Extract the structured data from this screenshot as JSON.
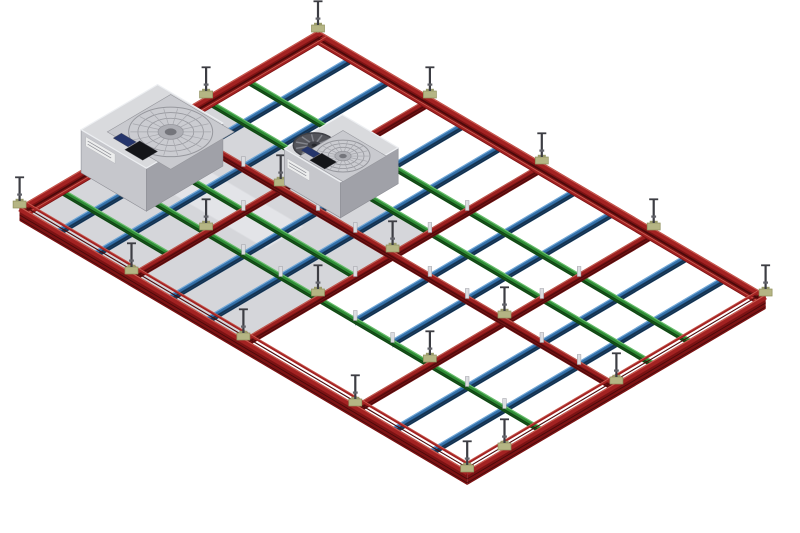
{
  "viewport": {
    "width": 800,
    "height": 533,
    "background": "#ffffff"
  },
  "scene": {
    "projection": {
      "origin_x": 318,
      "origin_y": 33,
      "cell_x": 37.3,
      "cell_y": 22
    },
    "grid": {
      "cells_u": 12,
      "cells_v": 8
    },
    "beam_styles": {
      "perimeter": {
        "side": "#7c1314",
        "ridge": "#4a0a0b",
        "top": "#a32222",
        "hi": "#c85a50",
        "side_h": 12,
        "top_w": 5
      },
      "red_runner": {
        "side": "#701112",
        "ridge": "#4c0a0b",
        "top": "#9c2020",
        "hi": "#c05a50",
        "side_h": 8,
        "top_w": 4
      },
      "blue": {
        "side": "#1c4165",
        "ridge": "#132e49",
        "top": "#336fa8",
        "hi": "#74aad9",
        "side_h": 6.5,
        "top_w": 3.2
      },
      "green": {
        "side": "#1a5c1e",
        "ridge": "#114214",
        "top": "#2f8c36",
        "hi": "#6cc06f",
        "side_h": 5.5,
        "top_w": 3.2
      }
    },
    "panels": [
      {
        "name": "blank-panel-area",
        "u0": 0,
        "u1": 6,
        "v0": 3,
        "v1": 8,
        "fill": "#d5d6da",
        "edge": "#c3c4c9"
      },
      {
        "name": "panel-highlight-strip",
        "u0": 1.6,
        "u1": 4.2,
        "v0": 4.6,
        "v1": 5.6,
        "fill": "#e3e4e8",
        "edge": "#dcdde1"
      }
    ],
    "beams": {
      "perimeter": [
        {
          "from": [
            0,
            0
          ],
          "to": [
            12,
            0
          ],
          "in": [
            0,
            1
          ]
        },
        {
          "from": [
            0,
            0
          ],
          "to": [
            0,
            8
          ],
          "in": [
            1,
            0
          ]
        },
        {
          "from": [
            12,
            0
          ],
          "to": [
            12,
            8
          ],
          "in": [
            -1,
            0
          ]
        },
        {
          "from": [
            0,
            8
          ],
          "to": [
            12,
            8
          ],
          "in": [
            0,
            -1
          ]
        }
      ],
      "red_runners": [
        {
          "from": [
            3,
            0
          ],
          "to": [
            3,
            8
          ]
        },
        {
          "from": [
            6,
            0
          ],
          "to": [
            6,
            8
          ]
        },
        {
          "from": [
            9,
            0
          ],
          "to": [
            9,
            8
          ]
        },
        {
          "from": [
            0,
            4
          ],
          "to": [
            12,
            4
          ]
        }
      ],
      "blue": [
        {
          "from": [
            1,
            0
          ],
          "to": [
            1,
            8
          ]
        },
        {
          "from": [
            2,
            0
          ],
          "to": [
            2,
            8
          ]
        },
        {
          "from": [
            4,
            0
          ],
          "to": [
            4,
            8
          ]
        },
        {
          "from": [
            5,
            0
          ],
          "to": [
            5,
            8
          ]
        },
        {
          "from": [
            7,
            0
          ],
          "to": [
            7,
            6
          ]
        },
        {
          "from": [
            8,
            0
          ],
          "to": [
            8,
            6
          ]
        },
        {
          "from": [
            10,
            0
          ],
          "to": [
            10,
            8
          ]
        },
        {
          "from": [
            11,
            0
          ],
          "to": [
            11,
            8
          ]
        }
      ],
      "green": [
        {
          "from": [
            0,
            2
          ],
          "to": [
            12,
            2
          ]
        },
        {
          "from": [
            0,
            3
          ],
          "to": [
            12,
            3
          ]
        },
        {
          "from": [
            0,
            5
          ],
          "to": [
            6,
            5
          ]
        },
        {
          "from": [
            0,
            6
          ],
          "to": [
            12,
            6
          ]
        },
        {
          "from": [
            0,
            7
          ],
          "to": [
            3,
            7
          ]
        }
      ]
    },
    "clips": [
      [
        1,
        4
      ],
      [
        2,
        4
      ],
      [
        4,
        4
      ],
      [
        5,
        4
      ],
      [
        7,
        4
      ],
      [
        8,
        4
      ],
      [
        10,
        4
      ],
      [
        11,
        4
      ],
      [
        3,
        2
      ],
      [
        6,
        2
      ],
      [
        9,
        2
      ],
      [
        3,
        3
      ],
      [
        6,
        3
      ],
      [
        9,
        3
      ],
      [
        3,
        5
      ],
      [
        6,
        5
      ],
      [
        4,
        6
      ],
      [
        5,
        6
      ],
      [
        7,
        6
      ],
      [
        8,
        6
      ],
      [
        10,
        6
      ],
      [
        11,
        6
      ]
    ],
    "clip_style": {
      "fill": "#dcdde1",
      "stroke": "#9b9ca2"
    },
    "hangers": [
      [
        0,
        0
      ],
      [
        3,
        0
      ],
      [
        6,
        0
      ],
      [
        9,
        0
      ],
      [
        12,
        0
      ],
      [
        0,
        3
      ],
      [
        0,
        6
      ],
      [
        0,
        8
      ],
      [
        3,
        8
      ],
      [
        6,
        8
      ],
      [
        9,
        8
      ],
      [
        12,
        8
      ],
      [
        12,
        4
      ],
      [
        12,
        7
      ],
      [
        3,
        4
      ],
      [
        6,
        4
      ],
      [
        9,
        4
      ],
      [
        3,
        6
      ],
      [
        6,
        6
      ],
      [
        9,
        6
      ]
    ],
    "hanger_style": {
      "bracket": "#b5b584",
      "bracket_dark": "#90905e",
      "plate": "#9a9b6b",
      "rod": "#3c3d43",
      "nut": "#62636a"
    },
    "ffu_colors": {
      "top": "#d9dadd",
      "face_left": "#c6c7cc",
      "face_right": "#a0a1a8",
      "outline": "#8e8f96",
      "top_edge": "#edeff2",
      "recess": "#c9cacf",
      "grille_fill": "#cbccd1",
      "ring": "#96979d",
      "spoke": "#a6a7ad",
      "hub": "#aeafb5",
      "hub_dark": "#74757b",
      "dark_fill": "#54555b",
      "dark_rim": "#3f4046",
      "dark_blade": "#83858c",
      "dark_hub": "#404148",
      "navy": "#25356b",
      "black": "#141518",
      "label_bg": "#eceded",
      "label_edge": "#b9babf",
      "label_text": "#8e8f96"
    },
    "ffus": [
      {
        "name": "fan-filter-unit-large",
        "u0": 0,
        "u1": 1.75,
        "v0": 4.3,
        "v1": 6.35,
        "h": 43,
        "fans": [
          {
            "kind": "grille",
            "cu": 1.25,
            "cv": 5.2,
            "r": 42,
            "recess": 0.85
          }
        ],
        "navy": {
          "cu": 0.82,
          "cv": 6.0,
          "a": 0.2,
          "b": 0.11
        },
        "black": {
          "cu": 1.28,
          "cv": 6.02,
          "a": 0.24,
          "b": 0.2
        },
        "label": {
          "t0": 0.07,
          "t1": 0.52,
          "z0": 0.68,
          "z1": 0.9
        }
      },
      {
        "name": "fan-filter-unit-small",
        "u0": 3,
        "u1": 4.5,
        "v0": 2.35,
        "v1": 3.9,
        "h": 36,
        "fans": [
          {
            "kind": "dark",
            "cu": 3.32,
            "cv": 3.42,
            "r": 21
          },
          {
            "kind": "grille",
            "cu": 3.95,
            "cv": 3.28,
            "r": 27,
            "recess": 0.58
          }
        ],
        "navy": {
          "cu": 3.42,
          "cv": 3.62,
          "a": 0.17,
          "b": 0.09
        },
        "black": {
          "cu": 3.8,
          "cv": 3.66,
          "a": 0.2,
          "b": 0.16
        },
        "label": {
          "t0": 0.05,
          "t1": 0.45,
          "z0": 0.52,
          "z1": 0.78
        }
      }
    ]
  }
}
